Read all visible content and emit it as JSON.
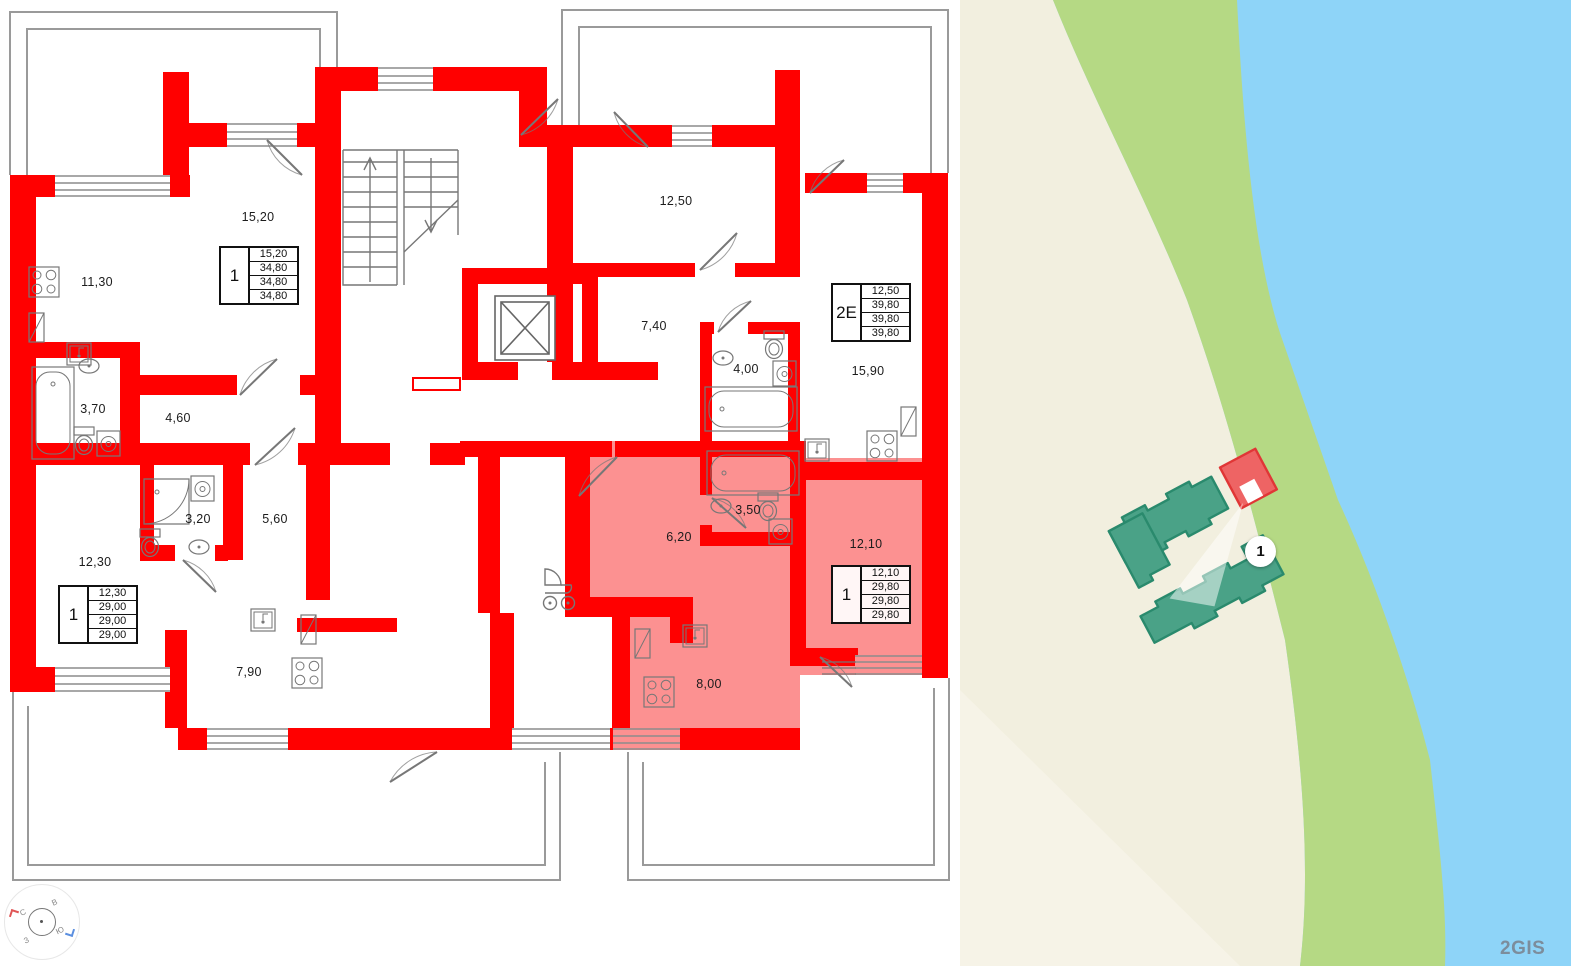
{
  "floorplan": {
    "rooms": [
      {
        "name": "kitchen-living",
        "label": "11,30"
      },
      {
        "name": "living-room",
        "label": "15,20"
      },
      {
        "name": "living-room",
        "label": "12,50"
      },
      {
        "name": "hallway",
        "label": "7,40"
      },
      {
        "name": "bathroom",
        "label": "4,00"
      },
      {
        "name": "kitchen-living",
        "label": "15,90"
      },
      {
        "name": "bathroom",
        "label": "3,70"
      },
      {
        "name": "hallway",
        "label": "4,60"
      },
      {
        "name": "shower-room",
        "label": "3,20"
      },
      {
        "name": "hallway",
        "label": "5,60"
      },
      {
        "name": "living-room",
        "label": "12,30"
      },
      {
        "name": "kitchen",
        "label": "7,90"
      },
      {
        "name": "hallway-selected",
        "label": "6,20"
      },
      {
        "name": "bathroom-selected",
        "label": "3,50"
      },
      {
        "name": "living-room-selected",
        "label": "12,10"
      },
      {
        "name": "kitchen-selected",
        "label": "8,00"
      }
    ],
    "tables": [
      {
        "type": "1",
        "rows": [
          "15,20",
          "34,80",
          "34,80",
          "34,80"
        ],
        "highlighted": false
      },
      {
        "type": "2Е",
        "rows": [
          "12,50",
          "39,80",
          "39,80",
          "39,80"
        ],
        "highlighted": false
      },
      {
        "type": "1",
        "rows": [
          "12,30",
          "29,00",
          "29,00",
          "29,00"
        ],
        "highlighted": false
      },
      {
        "type": "1",
        "rows": [
          "12,10",
          "29,80",
          "29,80",
          "29,80"
        ],
        "highlighted": true
      }
    ],
    "compass": {
      "north": "С",
      "east": "В",
      "south": "Ю",
      "west": "З"
    },
    "colors": {
      "wall": "#ff0000",
      "highlight": "#fc9191",
      "lines": "#8c8c8c"
    }
  },
  "map": {
    "badge_label": "1",
    "attribution": "2GIS",
    "colors": {
      "water": "#8ed4f8",
      "land": "#f2efdf",
      "land_light": "#f6f3e8",
      "greenery": "#b5d984",
      "building": "#4aa287",
      "building_outline": "#2a8a6d",
      "highlight_building": "#ee6464",
      "highlight_outline": "#e03636"
    }
  }
}
